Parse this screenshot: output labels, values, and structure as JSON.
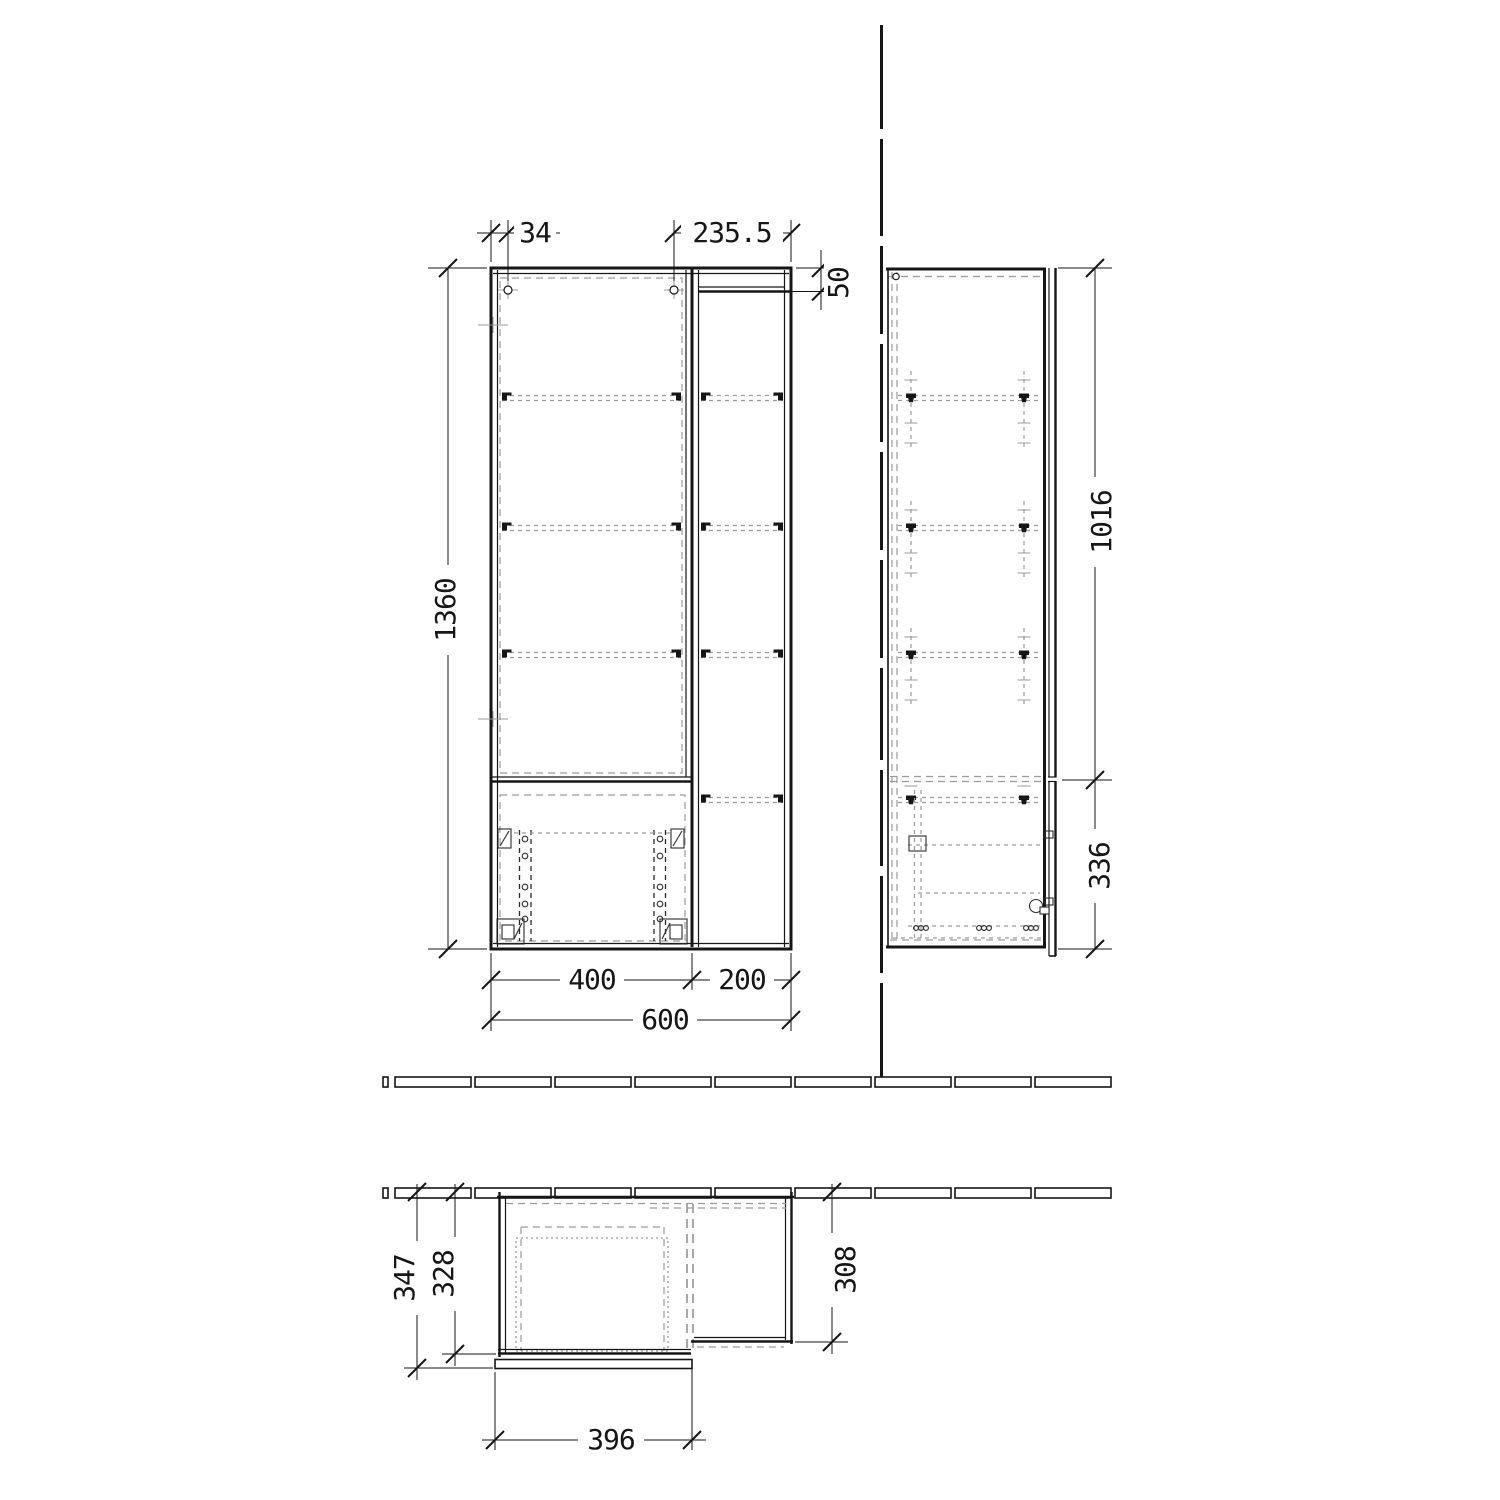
{
  "dimensions": {
    "front": {
      "hinge_offset": "34",
      "top_width_right": "235.5",
      "niche_top_height": "50",
      "height": "1360",
      "door_width": "400",
      "niche_width": "200",
      "total_width": "600"
    },
    "side": {
      "upper_height": "1016",
      "lower_height": "336"
    },
    "plan": {
      "depth_with_front": "347",
      "depth_carcass": "328",
      "depth_open_shelf": "308",
      "drawer_front_width": "396"
    }
  }
}
